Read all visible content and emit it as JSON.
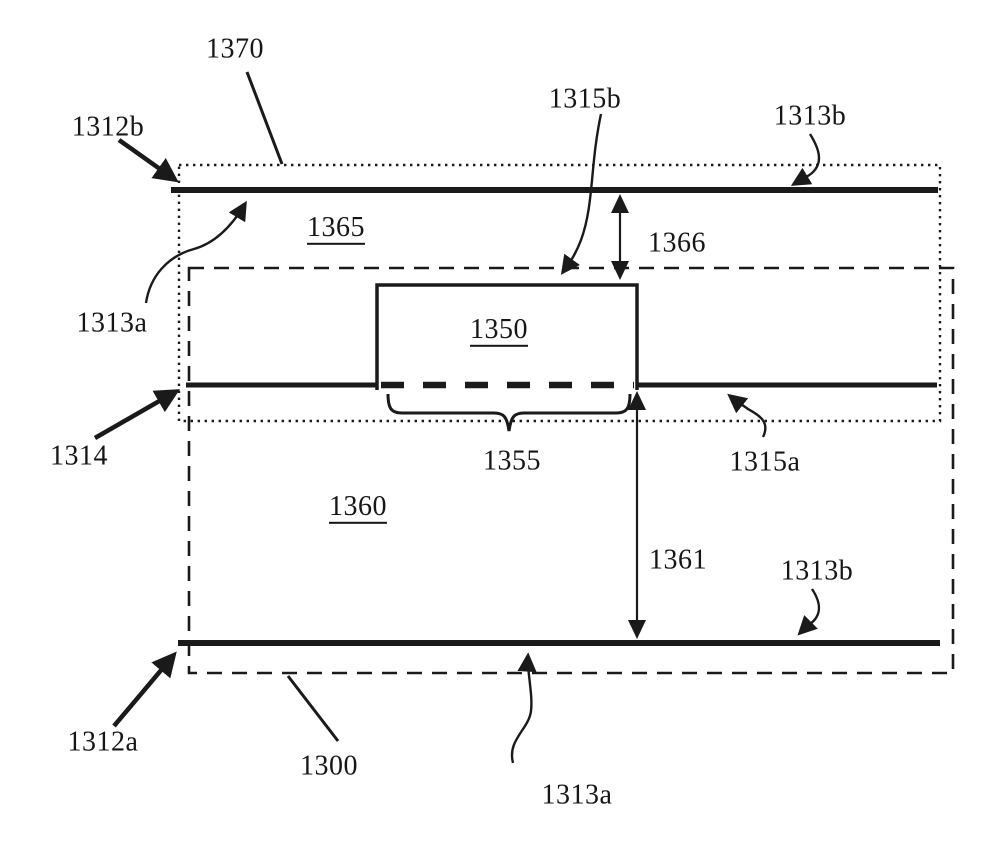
{
  "figure": {
    "kind": "patent-cross-section-diagram",
    "background_color": "#ffffff",
    "line_color": "#1a1a1a",
    "labels": {
      "l1370": {
        "text": "1370",
        "underlined": false
      },
      "l1312b": {
        "text": "1312b",
        "underlined": false
      },
      "l1315b": {
        "text": "1315b",
        "underlined": false
      },
      "l1313b_top": {
        "text": "1313b",
        "underlined": false
      },
      "l1365": {
        "text": "1365",
        "underlined": true
      },
      "l1366": {
        "text": "1366",
        "underlined": false
      },
      "l1313a_top": {
        "text": "1313a",
        "underlined": false
      },
      "l1350": {
        "text": "1350",
        "underlined": true
      },
      "l1314": {
        "text": "1314",
        "underlined": false
      },
      "l1355": {
        "text": "1355",
        "underlined": false
      },
      "l1315a": {
        "text": "1315a",
        "underlined": false
      },
      "l1360": {
        "text": "1360",
        "underlined": true
      },
      "l1361": {
        "text": "1361",
        "underlined": false
      },
      "l1313b_bottom": {
        "text": "1313b",
        "underlined": false
      },
      "l1312a": {
        "text": "1312a",
        "underlined": false
      },
      "l1300": {
        "text": "1300",
        "underlined": false
      },
      "l1313a_bottom": {
        "text": "1313a",
        "underlined": false
      }
    }
  }
}
